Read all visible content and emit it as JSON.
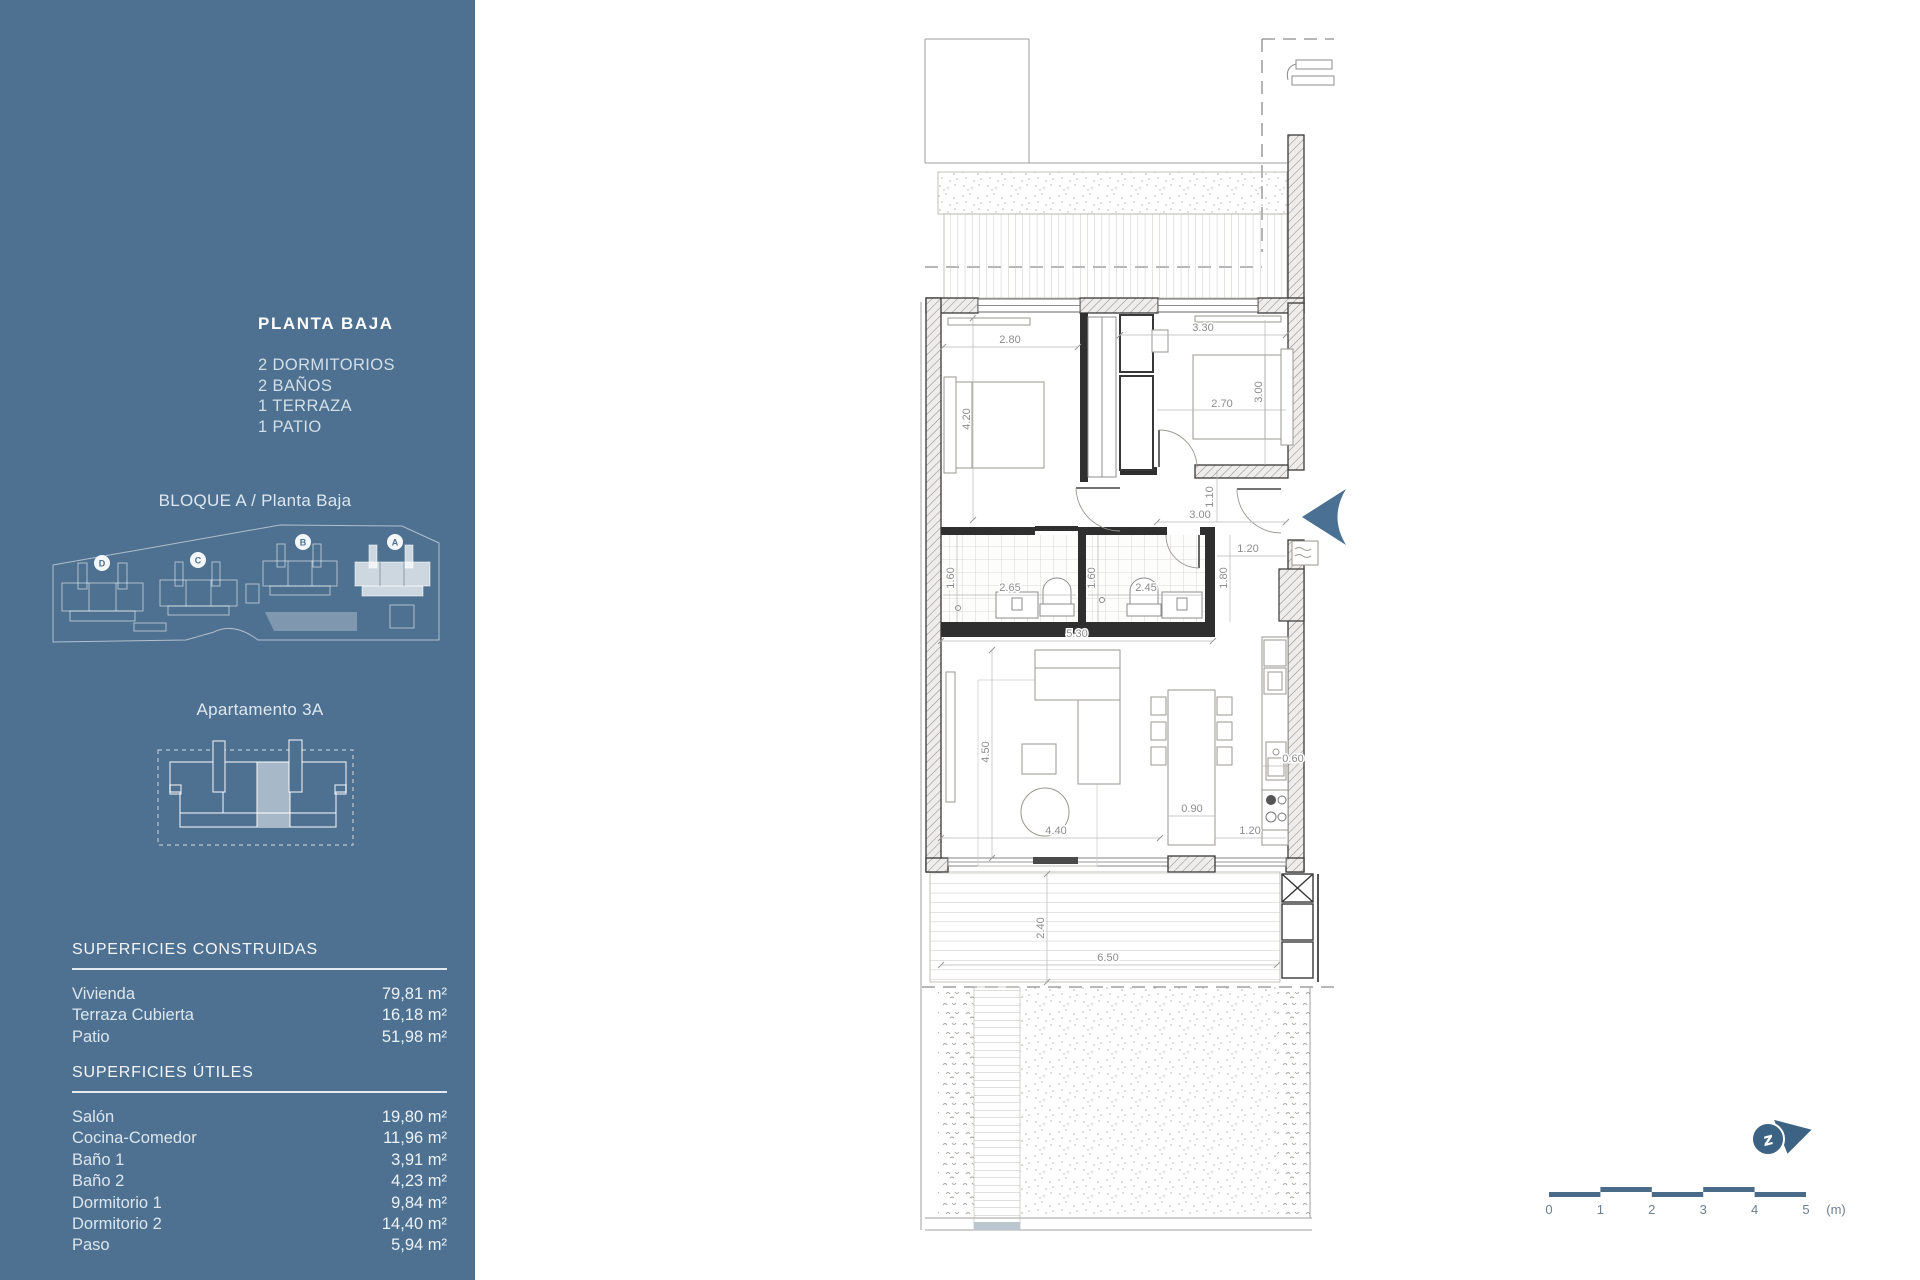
{
  "sidebar": {
    "plan_title": "PLANTA BAJA",
    "features": [
      "2 DORMITORIOS",
      "2 BAÑOS",
      "1 TERRAZA",
      "1 PATIO"
    ],
    "block_label": "BLOQUE A / Planta Baja",
    "siteplan": {
      "blocks": [
        "D",
        "C",
        "B",
        "A"
      ],
      "highlighted": "A"
    },
    "apartment_label": "Apartamento 3A",
    "superficies_construidas": {
      "title": "SUPERFICIES CONSTRUIDAS",
      "rows": [
        {
          "label": "Vivienda",
          "value": "79,81 m²"
        },
        {
          "label": "Terraza Cubierta",
          "value": "16,18 m²"
        },
        {
          "label": "Patio",
          "value": "51,98 m²"
        }
      ]
    },
    "superficies_utiles": {
      "title": "SUPERFICIES ÚTILES",
      "rows": [
        {
          "label": "Salón",
          "value": "19,80 m²"
        },
        {
          "label": "Cocina-Comedor",
          "value": "11,96 m²"
        },
        {
          "label": "Baño 1",
          "value": "3,91 m²"
        },
        {
          "label": "Baño 2",
          "value": "4,23 m²"
        },
        {
          "label": "Dormitorio 1",
          "value": "9,84 m²"
        },
        {
          "label": "Dormitorio 2",
          "value": "14,40 m²"
        },
        {
          "label": "Paso",
          "value": "5,94 m²"
        }
      ]
    }
  },
  "plan": {
    "dims": [
      "2.80",
      "3.30",
      "4.20",
      "2.70",
      "3.00",
      "1.10",
      "3.00",
      "1.20",
      "1.80",
      "1.60",
      "2.65",
      "1.60",
      "2.45",
      "5.30",
      "4.50",
      "0.90",
      "4.40",
      "1.20",
      "0.60",
      "2.40",
      "6.50"
    ],
    "compass_glyph": "z"
  },
  "scalebar": {
    "labels": [
      "0",
      "1",
      "2",
      "3",
      "4",
      "5"
    ],
    "unit": "(m)"
  },
  "colors": {
    "sidebar": "#4e7191",
    "accent": "#4a7093",
    "compass": "#3d6384",
    "scalebar": "#4a6b88"
  }
}
